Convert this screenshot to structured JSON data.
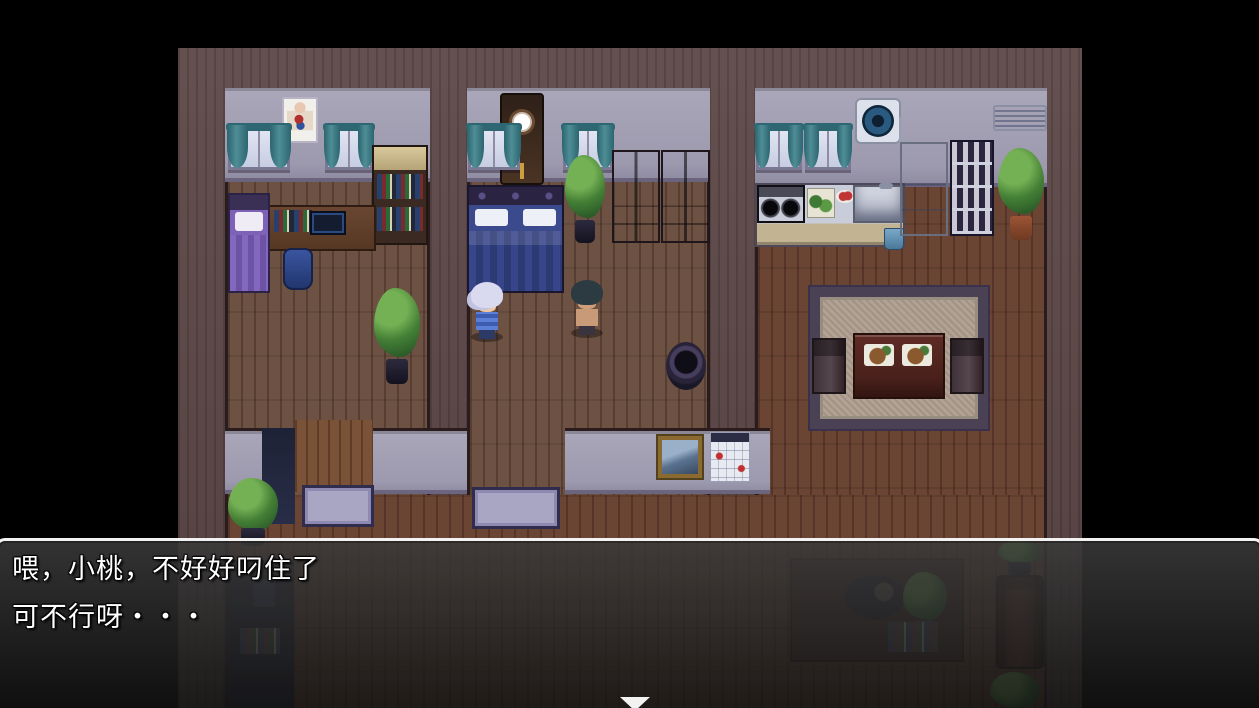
{
  "dialog": {
    "lines": [
      "喂，小桃，不好好叼住了",
      "可不行呀・・・"
    ],
    "text_color": "#ffffff",
    "border_color": "#ffffff",
    "continue_indicator": "down-triangle"
  },
  "scene": {
    "letterbox_color": "#000000",
    "palette": {
      "outer_wall": "#5d4747",
      "room_wall": "#a6a2b6",
      "floor_upper": "#6d5244",
      "floor_lower": "#6b4534",
      "curtain_teal": "#3f7d86",
      "trim_dark": "#2a1c1c"
    },
    "rooms": [
      {
        "name": "bedroom-study",
        "objects": [
          "anatomy-poster",
          "window",
          "window",
          "single-bed-purple",
          "desk-with-computer",
          "bookshelf",
          "blue-bin",
          "potted-plant"
        ]
      },
      {
        "name": "master-bedroom",
        "objects": [
          "wall-clock",
          "window",
          "window",
          "double-bed-blue",
          "potted-plant",
          "wardrobe",
          "wardrobe"
        ]
      },
      {
        "name": "kitchen",
        "objects": [
          "window",
          "window",
          "exhaust-fan",
          "air-conditioner",
          "stove",
          "cutting-board",
          "dish-with-tomatoes",
          "sink",
          "counter",
          "small-trash-bin",
          "refrigerator",
          "dish-cabinet",
          "potted-plant"
        ]
      },
      {
        "name": "dining-area",
        "objects": [
          "area-rug",
          "dining-table",
          "meal-plate",
          "meal-plate",
          "chair",
          "chair"
        ]
      },
      {
        "name": "hallway",
        "objects": [
          "woven-basket",
          "doormat",
          "doormat",
          "doorway",
          "picture-frame",
          "wall-calendar",
          "potted-plant"
        ]
      },
      {
        "name": "living-area",
        "objects": [
          "telephone",
          "book-pile",
          "sleeping-cat",
          "potted-plant",
          "books",
          "sofa",
          "potted-plant",
          "plant-stand"
        ]
      }
    ],
    "characters": [
      {
        "name": "player-girl",
        "hair_color": "#d9d9ef",
        "outfit_color": "#4a6fc0",
        "facing": "right"
      },
      {
        "name": "npc-man",
        "hair_color": "#2c3a42",
        "skin_color": "#c99a78",
        "facing": "left"
      }
    ]
  }
}
